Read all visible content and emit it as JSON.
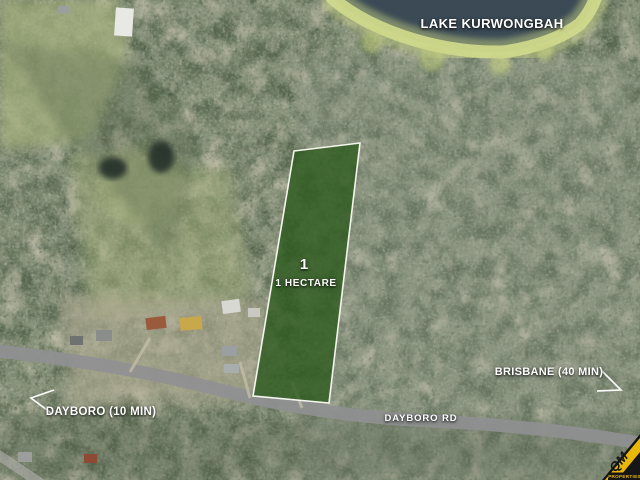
{
  "map": {
    "lake_label": "LAKE KURWONGBAH",
    "parcel": {
      "number": "1",
      "area": "1 HECTARE"
    },
    "directions": {
      "brisbane": "BRISBANE (40 MIN)",
      "dayboro": "DAYBORO (10 MIN)"
    },
    "road_label": "DAYBORO RD",
    "colors": {
      "water": "#3b4a55",
      "shore_fringe": "#d2dc8d",
      "parcel_fill": "#2d5a1e",
      "parcel_border": "#f5f5ee",
      "road": "#8f9091",
      "label_text": "#ffffff"
    }
  },
  "logo": {
    "brand": "QM",
    "tagline": "PROPERTIES",
    "yellow": "#e9b70a",
    "black": "#161616"
  }
}
